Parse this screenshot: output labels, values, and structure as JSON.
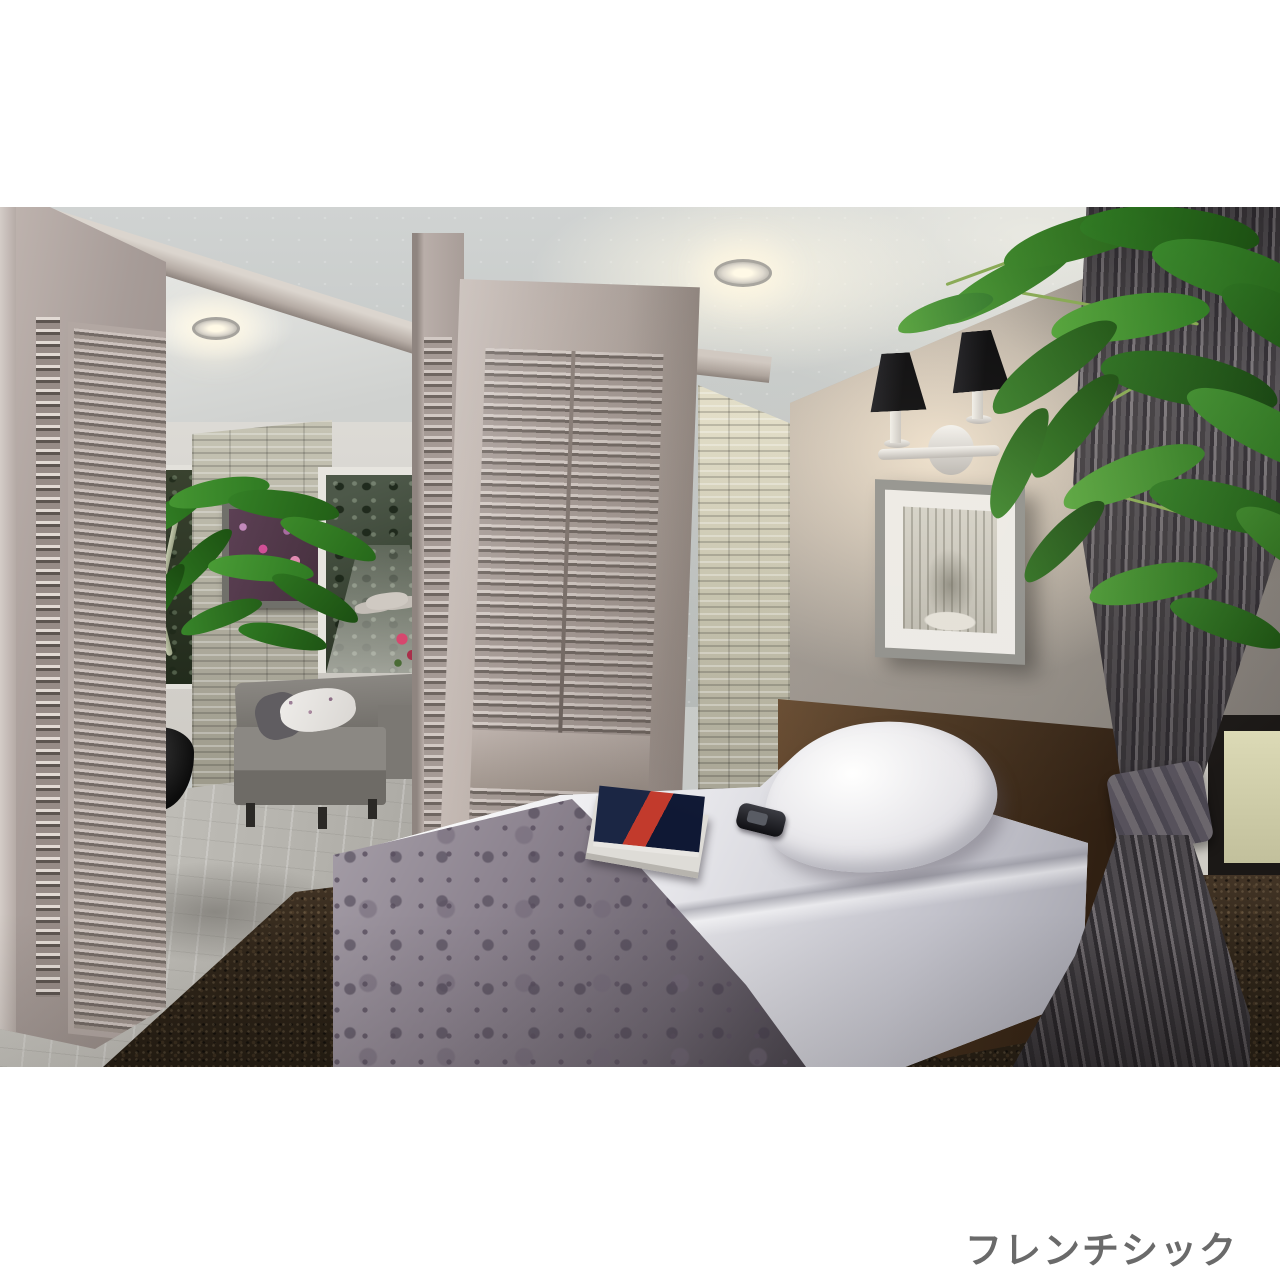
{
  "caption": {
    "text": "フレンチシック"
  },
  "palette": {
    "page_background": "#ffffff",
    "caption_text": "#6a6a6a",
    "ceiling": "#c7cac8",
    "accent_wall": "#8e8881",
    "stone_wall": "#b3b0a0",
    "louver_doors": "#b1a6a0",
    "headboard_wood": "#46311d",
    "bedding_white": "#e9e8ea",
    "blanket_damask": "#8d8490",
    "carpet": "#2f2519",
    "curtain": "#4a474b",
    "plant_leaves": "#3c8a2c",
    "sconce_shades": "#08080a",
    "magazine_red": "#c23a2c",
    "magazine_navy": "#1b2644"
  },
  "scene": {
    "objects": [
      "ceiling-with-recessed-downlights",
      "living-room-view-through-opening",
      "louvered-closet-doors",
      "sliding-louver-partition-doors",
      "stacked-stone-column",
      "gray-accent-wall",
      "double-black-wall-sconce",
      "framed-botanical-art",
      "single-bed-with-damask-throw",
      "magazines-and-phone-on-bed",
      "dark-brown-carpet",
      "tied-back-gray-curtain",
      "green-houseplant-foliage"
    ]
  }
}
